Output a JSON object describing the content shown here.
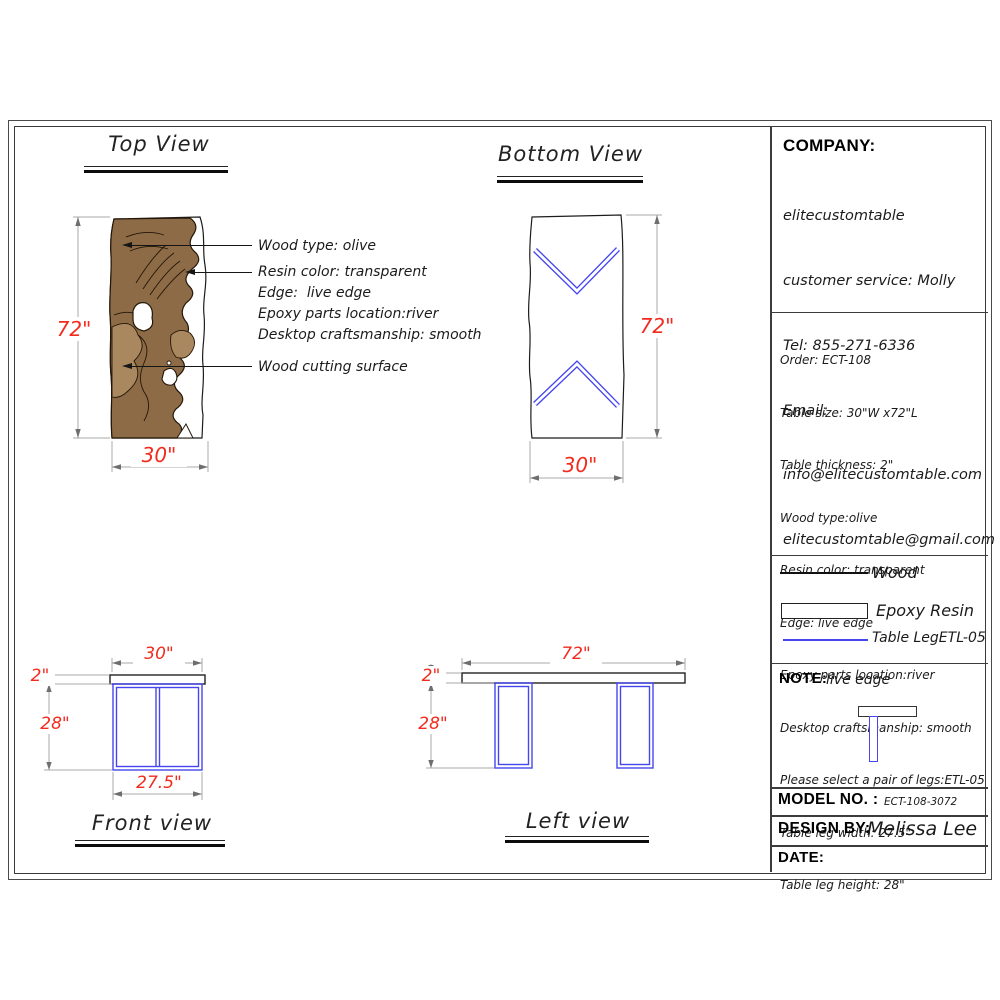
{
  "colors": {
    "accent_red": "#f32b1e",
    "leg_blue": "#4646ee",
    "wood_dark": "#8d6b47",
    "wood_light": "#a9885f",
    "outline": "#241708"
  },
  "views": {
    "top": {
      "title": "Top View",
      "dim_height": "72\"",
      "dim_width": "30\"",
      "labels": {
        "wood_type": "Wood type: olive",
        "resin_color": "Resin color: transparent",
        "edge": "Edge:  live edge",
        "epoxy_location": "Epoxy parts location:river",
        "craftsmanship": "Desktop craftsmanship: smooth",
        "cutting_surface": "Wood cutting surface"
      }
    },
    "bottom": {
      "title": "Bottom View",
      "dim_height": "72\"",
      "dim_width": "30\""
    },
    "front": {
      "title": "Front view",
      "dim_width": "30\"",
      "dim_thickness": "2\"",
      "dim_leg_height": "28\"",
      "dim_leg_width": "27.5\""
    },
    "left": {
      "title": "Left view",
      "dim_length": "72\"",
      "dim_thickness": "2\"",
      "dim_leg_height": "28\""
    }
  },
  "company": {
    "label": "COMPANY:",
    "lines": [
      "elitecustomtable",
      "customer service: Molly",
      "Tel: 855-271-6336",
      "Email:",
      "info@elitecustomtable.com",
      "elitecustomtable@gmail.com"
    ]
  },
  "order": {
    "lines": [
      "Order: ECT-108",
      "Table size: 30\"W x72\"L",
      "Table thickness: 2\"",
      "Wood type:olive",
      "Resin color: transparent",
      "Edge: live edge",
      "Epoxy parts location:river",
      "Desktop craftsmanship: smooth",
      "Please select a pair of legs:ETL-05",
      "Table leg width: 27.5\"",
      "Table leg height: 28\""
    ]
  },
  "legend": {
    "wood": "Wood",
    "epoxy": "Epoxy Resin",
    "leg": "Table LegETL-05"
  },
  "note": {
    "label": "NOTE:",
    "text": "live edge"
  },
  "title_block": {
    "model_label": "MODEL NO. :",
    "model_value": "ECT-108-3072",
    "design_label": "DESIGN BY:",
    "design_value": "Melissa Lee",
    "date_label": "DATE:"
  }
}
